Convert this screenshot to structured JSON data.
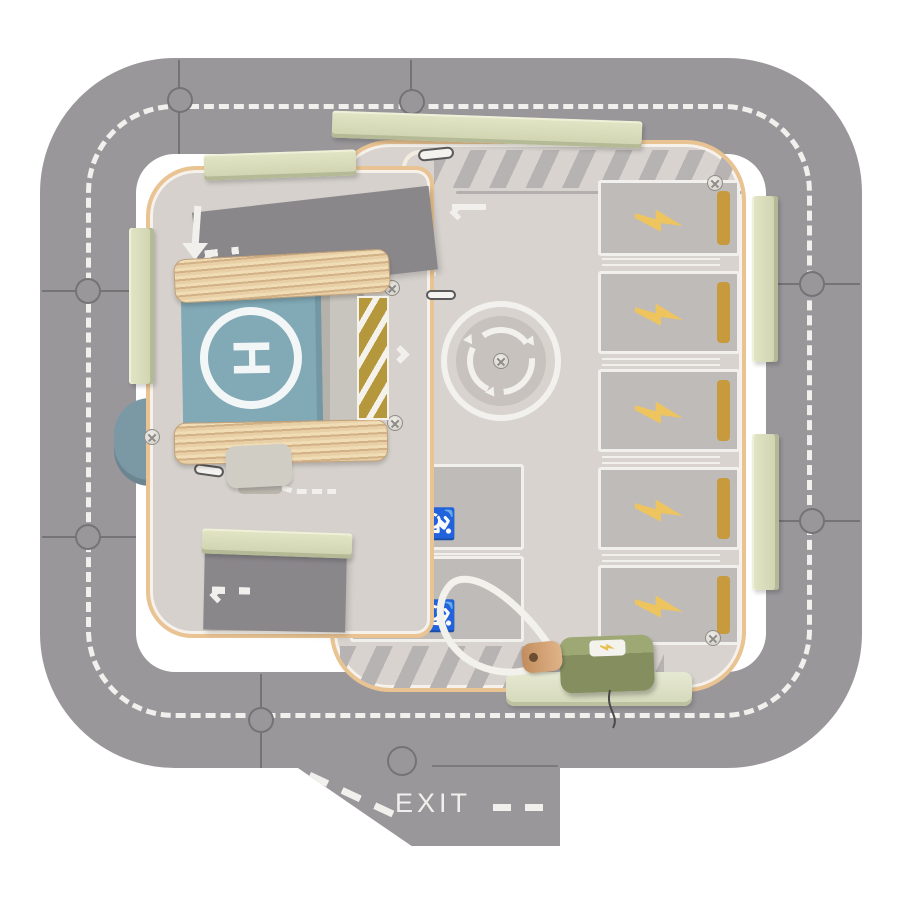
{
  "scene": {
    "description": "Top view photo of a wooden toy parking-garage playset: gray puzzle-piece ring road with dashed centerline, inner parking boards, helipad block, EV charging bays, accessible bays, roundabout, charging station with cord, and an EXIT ramp piece",
    "background": "#ffffff"
  },
  "palette": {
    "road": "#9a979b",
    "road_marking": "#f2f0ed",
    "board": "#d8d3cf",
    "board_edge": "#e9c392",
    "ramp_dark": "#8a878b",
    "hatch": "#b7b3b2",
    "bay_fill": "#bfbbb8",
    "bay_outline": "#f2f0ed",
    "gold": "#c79a3d",
    "bolt_gold": "#eec45e",
    "stick_green": "#d9dcba",
    "base_green": "#e0e4cd",
    "charger_olive": "#8d9768",
    "peg_wood": "#d8a87e",
    "cord_white": "#f3f1ec",
    "helipad_blue": "#81a9b6",
    "helipad_white": "#f2f6f6",
    "knob_blue": "#7b98a5",
    "plywood": "#e8cfa5",
    "roller": "#d0cdc5",
    "roundabout": "#f3f1ed"
  },
  "road": {
    "type": "puzzle ring road",
    "marking": "white dashed centerline",
    "puzzle_joints": 8
  },
  "exit": {
    "label": "EXIT"
  },
  "helipad": {
    "label": "H",
    "symbol": "circled-H helipad block on plywood platforms"
  },
  "parking": {
    "ev_bays": {
      "count": 5,
      "icon": "lightning-bolt-icon",
      "gold_bar": "right edge"
    },
    "accessible_bays": {
      "count": 2,
      "p_label": "P",
      "wheelchair_glyph": "♿",
      "gold_bar": "left edge"
    }
  },
  "roundabout": {
    "icon": "circular-arrows-icon",
    "center": "screw"
  },
  "charger": {
    "icon": "lightning-bolt-icon",
    "plug": "wooden-peg",
    "cable": "white-cord"
  },
  "loose_parts": {
    "green_sticks": 6,
    "green_base_strip": 1,
    "blue_knob": 1
  },
  "direction_markings": {
    "upper_ramp": "left chevrons with dashes",
    "lower_ramp": "left chevrons with dashes",
    "entry_arrow": "triple left chevrons with tail bar",
    "merge": "double right chevrons",
    "down_arrow": "white down arrow"
  }
}
